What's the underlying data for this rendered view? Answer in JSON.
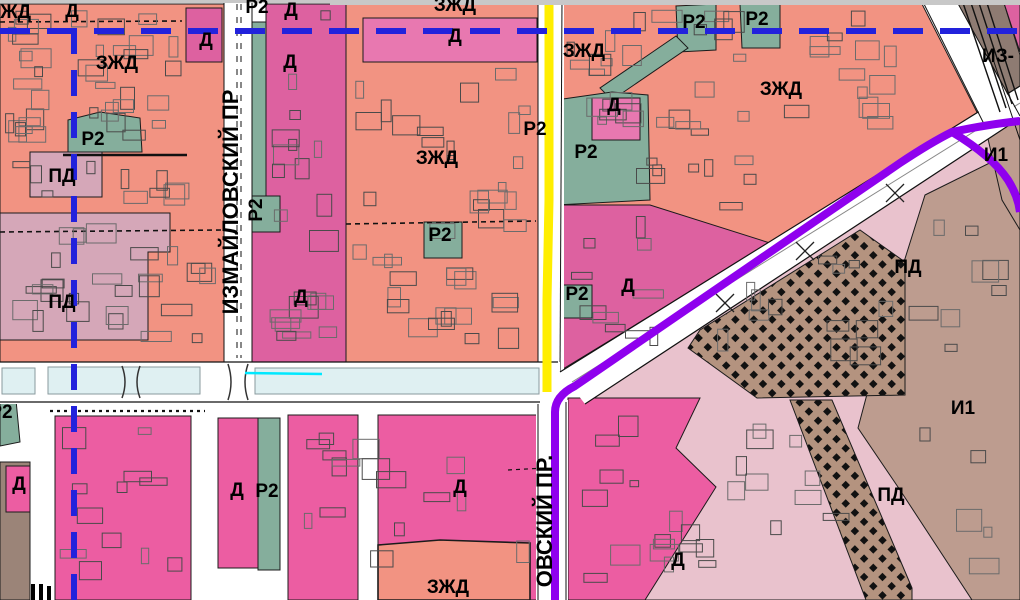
{
  "map": {
    "title": "city-zoning-map",
    "zone_labels": [
      {
        "text": "ЗЖД",
        "x": 10,
        "y": 18
      },
      {
        "text": "Д",
        "x": 72,
        "y": 17
      },
      {
        "text": "Р2",
        "x": 257,
        "y": 13
      },
      {
        "text": "Д",
        "x": 291,
        "y": 16
      },
      {
        "text": "Д",
        "x": 206,
        "y": 46
      },
      {
        "text": "ЗЖД",
        "x": 455,
        "y": 11
      },
      {
        "text": "Д",
        "x": 455,
        "y": 42
      },
      {
        "text": "Р2",
        "x": 694,
        "y": 28
      },
      {
        "text": "Р2",
        "x": 757,
        "y": 25
      },
      {
        "text": "ИЗ-",
        "x": 998,
        "y": 62
      },
      {
        "text": "ЗЖД",
        "x": 117,
        "y": 69
      },
      {
        "text": "Д",
        "x": 290,
        "y": 68
      },
      {
        "text": "ЗЖД",
        "x": 584,
        "y": 57
      },
      {
        "text": "ЗЖД",
        "x": 781,
        "y": 95
      },
      {
        "text": "Д",
        "x": 614,
        "y": 111
      },
      {
        "text": "Р2",
        "x": 93,
        "y": 145
      },
      {
        "text": "Р2",
        "x": 535,
        "y": 135
      },
      {
        "text": "Р2",
        "x": 586,
        "y": 158
      },
      {
        "text": "И1",
        "x": 996,
        "y": 161
      },
      {
        "text": "ЗЖД",
        "x": 437,
        "y": 164
      },
      {
        "text": "ПД",
        "x": 62,
        "y": 182
      },
      {
        "text": "Р2",
        "x": 262,
        "y": 210,
        "rotation": -90
      },
      {
        "text": "Р2",
        "x": 440,
        "y": 241
      },
      {
        "text": "ПД",
        "x": 62,
        "y": 308
      },
      {
        "text": "Д",
        "x": 301,
        "y": 303
      },
      {
        "text": "ПД",
        "x": 908,
        "y": 273
      },
      {
        "text": "Д",
        "x": 628,
        "y": 292
      },
      {
        "text": "Р2",
        "x": 577,
        "y": 300
      },
      {
        "text": "И1",
        "x": 963,
        "y": 414
      },
      {
        "text": "Р2",
        "x": 1,
        "y": 418
      },
      {
        "text": "Д",
        "x": 19,
        "y": 490
      },
      {
        "text": "Д",
        "x": 237,
        "y": 496
      },
      {
        "text": "Р2",
        "x": 267,
        "y": 497
      },
      {
        "text": "Д",
        "x": 460,
        "y": 493
      },
      {
        "text": "ПД",
        "x": 891,
        "y": 501
      },
      {
        "text": "Д",
        "x": 678,
        "y": 566
      },
      {
        "text": "ЗЖД",
        "x": 448,
        "y": 593
      }
    ],
    "street_labels": [
      {
        "text": "ИЗМАЙЛОВСКИЙ ПР",
        "x": 238,
        "y": 202,
        "rotation": -90
      },
      {
        "text": "ОВСКИЙ ПР.",
        "x": 552,
        "y": 521,
        "rotation": -90
      }
    ],
    "zone_colors": {
      "zhd_salmon": "#f29382",
      "d_magenta": "#dd61a0",
      "d_bright_pink": "#ec5da2",
      "d_band_pink": "#e878b0",
      "r2_teal": "#85ae9c",
      "pd_mauve": "#d5a7b8",
      "pd_light_pink": "#e9c2cd",
      "i1_brown": "#bd9c8f",
      "dark_brown": "#9b8478",
      "checker_brown": "#b4937f",
      "railway_gray": "#8e7b72",
      "water_blue": "#dff0f2",
      "top_strip_gray": "#c8c8c8"
    },
    "line_colors": {
      "metro_dashed_blue": "#2222dc",
      "route_purple": "#8f00ee",
      "road_yellow": "#ffee00",
      "stream_cyan": "#00e8ff"
    }
  }
}
